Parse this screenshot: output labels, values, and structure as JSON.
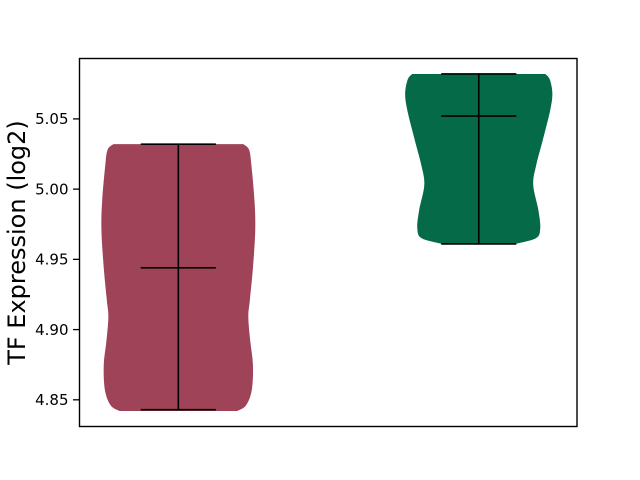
{
  "figure": {
    "background": "#ffffff",
    "title": ""
  },
  "chart_data": {
    "type": "violin",
    "title": "",
    "xlabel": "",
    "ylabel": "TF Expression (log2)",
    "grid": false,
    "legend": null,
    "ylim": [
      4.831,
      5.093
    ],
    "xlim": [
      -0.329,
      1.327
    ],
    "yticks": [
      4.85,
      4.9,
      4.95,
      5.0,
      5.05
    ],
    "ytick_labels": [
      "4.85",
      "4.90",
      "4.95",
      "5.00",
      "5.05"
    ],
    "xtick_labels": [],
    "marks_shown": [
      "min",
      "max",
      "mean",
      "range-line"
    ],
    "line_color": "#000000",
    "groups": [
      {
        "name": "violin-left",
        "position": 0,
        "color": "#9f4458",
        "min": 4.843,
        "max": 5.032,
        "mean": 4.944,
        "max_halfwidth": 0.256,
        "cap_halfwidth": 0.125,
        "profile": [
          [
            5.032,
            0.845
          ],
          [
            5.028,
            0.92
          ],
          [
            5.017,
            0.95
          ],
          [
            4.992,
            0.99
          ],
          [
            4.971,
            1.0
          ],
          [
            4.944,
            0.97
          ],
          [
            4.921,
            0.93
          ],
          [
            4.909,
            0.91
          ],
          [
            4.892,
            0.935
          ],
          [
            4.875,
            0.97
          ],
          [
            4.857,
            0.955
          ],
          [
            4.846,
            0.88
          ],
          [
            4.842,
            0.765
          ]
        ]
      },
      {
        "name": "violin-right",
        "position": 1,
        "color": "#046a47",
        "min": 4.961,
        "max": 5.082,
        "mean": 5.052,
        "max_halfwidth": 0.245,
        "cap_halfwidth": 0.125,
        "profile": [
          [
            5.082,
            0.905
          ],
          [
            5.078,
            0.966
          ],
          [
            5.068,
            1.0
          ],
          [
            5.056,
            0.97
          ],
          [
            5.035,
            0.87
          ],
          [
            5.017,
            0.78
          ],
          [
            5.003,
            0.74
          ],
          [
            4.985,
            0.81
          ],
          [
            4.972,
            0.835
          ],
          [
            4.965,
            0.775
          ],
          [
            4.961,
            0.5
          ]
        ]
      }
    ]
  }
}
